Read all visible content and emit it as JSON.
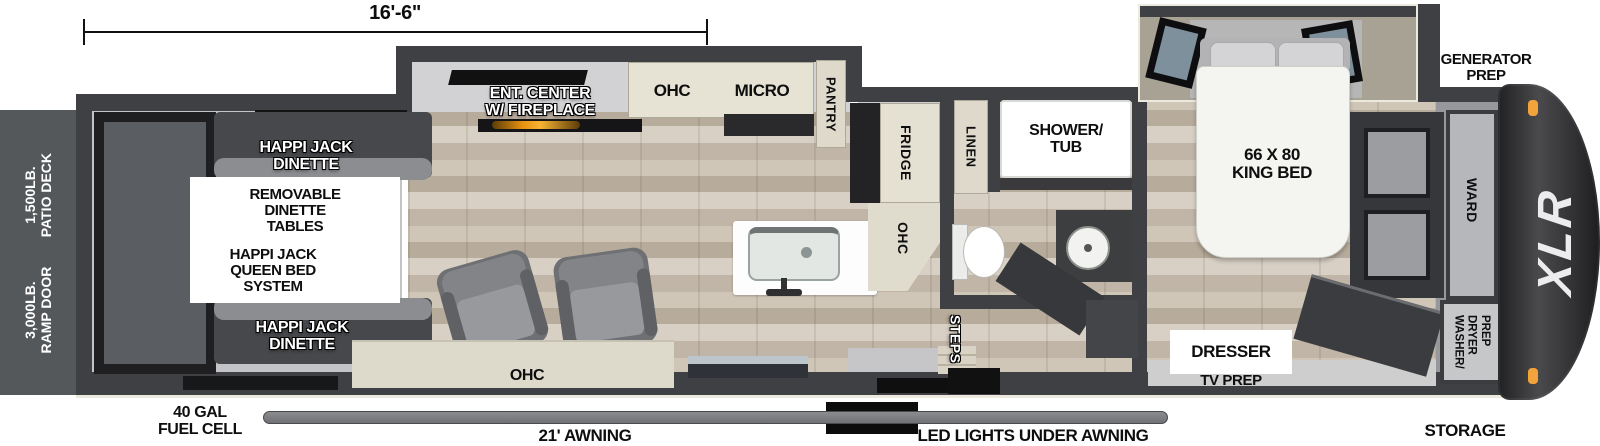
{
  "brand": "XLR",
  "dimension_label": "16'-6\"",
  "exterior": {
    "patio_deck": "1,500LB.\nPATIO DECK",
    "ramp_door": "3,000LB.\nRAMP DOOR",
    "generator_prep": "GENERATOR\nPREP",
    "storage": "STORAGE",
    "fuel_cell": "40 GAL\nFUEL CELL",
    "awning": "21' AWNING",
    "led_lights": "LED LIGHTS UNDER AWNING"
  },
  "garage": {
    "dinette_top": "HAPPI JACK\nDINETTE",
    "removable_tables": "REMOVABLE\nDINETTE\nTABLES",
    "queen_bed": "HAPPI JACK\nQUEEN BED\nSYSTEM",
    "dinette_bottom": "HAPPI JACK\nDINETTE"
  },
  "living": {
    "ent_center": "ENT. CENTER\nW/ FIREPLACE",
    "ohc": "OHC",
    "micro": "MICRO",
    "pantry": "PANTRY",
    "ohc_lower": "OHC"
  },
  "kitchen": {
    "fridge": "FRIDGE",
    "ohc": "OHC"
  },
  "bath": {
    "linen": "LINEN",
    "shower_tub": "SHOWER/\nTUB",
    "steps": "STEPS"
  },
  "bedroom": {
    "king_bed": "66 X 80\nKING BED",
    "dresser": "DRESSER",
    "tv_prep": "TV PREP",
    "ward": "WARD",
    "washer_dryer": "WASHER/\nDRYER\nPREP"
  },
  "colors": {
    "wall": "#3f4043",
    "cabinet": "#ded9cb",
    "floor_wood": "#c8beb0",
    "marker_light": "#f2a33c"
  }
}
